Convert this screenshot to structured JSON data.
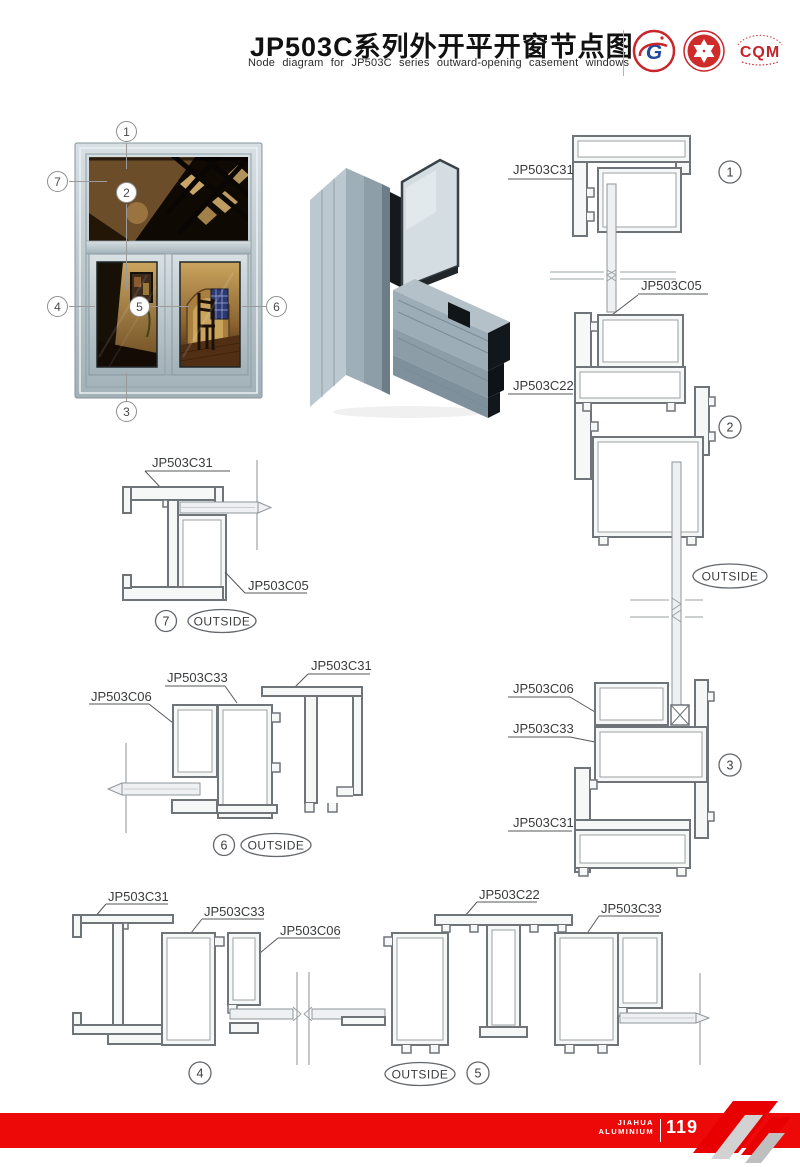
{
  "header": {
    "title_cn": "JP503C系列外开平开窗节点图",
    "title_en": "Node diagram for JP503C series outward-opening casement windows",
    "logos": {
      "gb": "G",
      "cqm": "CQM"
    }
  },
  "window_photo": {
    "callouts": {
      "c1": "1",
      "c2": "2",
      "c3": "3",
      "c4": "4",
      "c5": "5",
      "c6": "6",
      "c7": "7"
    }
  },
  "right_column": {
    "sec1": {
      "num": "1",
      "part": "JP503C31"
    },
    "sec2": {
      "part_top": "JP503C05",
      "part": "JP503C22",
      "num": "2"
    },
    "outside": "OUTSIDE",
    "sec3": {
      "part_a": "JP503C06",
      "part_b": "JP503C33",
      "num": "3",
      "part_c": "JP503C31"
    }
  },
  "detail7": {
    "num": "7",
    "part_a": "JP503C31",
    "part_b": "JP503C05",
    "outside": "OUTSIDE"
  },
  "detail6": {
    "num": "6",
    "part_a": "JP503C06",
    "part_b": "JP503C33",
    "part_c": "JP503C31",
    "outside": "OUTSIDE"
  },
  "detail4": {
    "num": "4",
    "part_a": "JP503C31",
    "part_b": "JP503C33",
    "part_c": "JP503C06"
  },
  "detail5": {
    "num": "5",
    "part_a": "JP503C22",
    "part_b": "JP503C33",
    "outside": "OUTSIDE"
  },
  "footer": {
    "brand_line1": "JIAHUA",
    "brand_line2": "ALUMINIUM",
    "page_number": "119"
  },
  "colors": {
    "accent_red": "#ee0909",
    "drawing_line": "#6e7478",
    "aluminium": "#aebcc4"
  }
}
